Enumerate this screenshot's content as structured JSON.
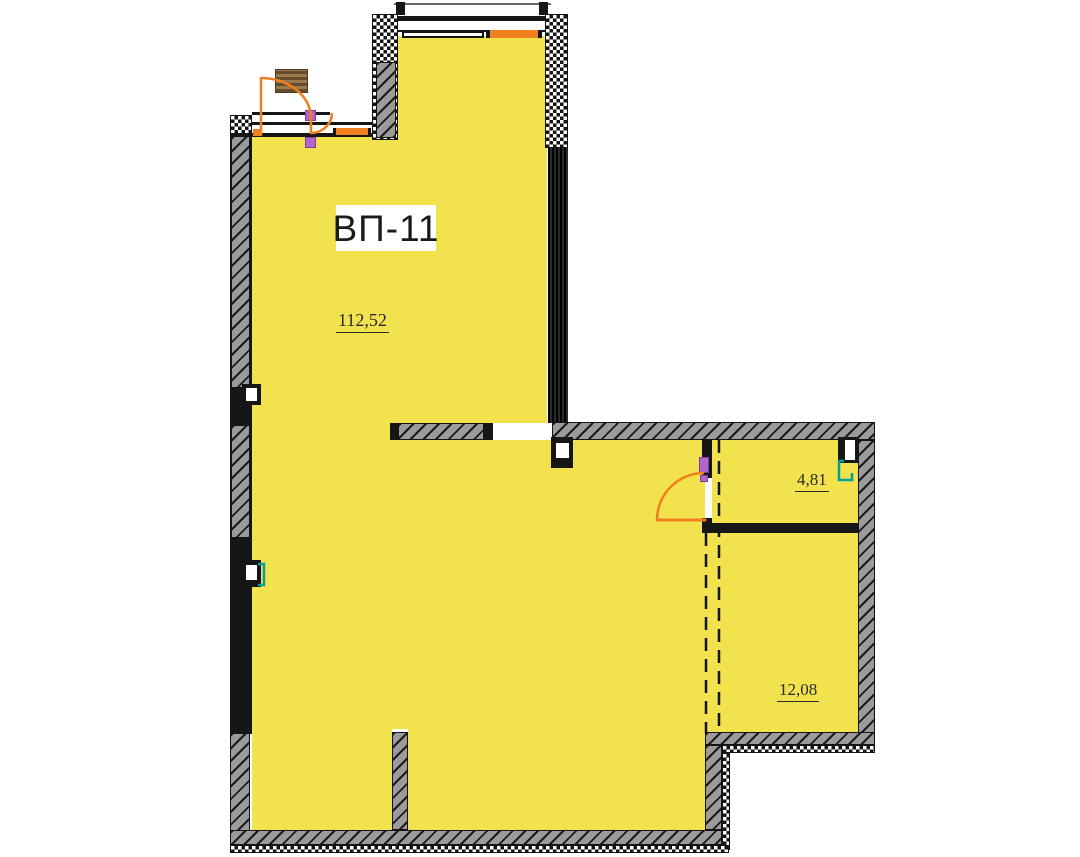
{
  "plan": {
    "unit_label": "ВП-11",
    "rooms": [
      {
        "name": "main-room",
        "area": "112,52"
      },
      {
        "name": "side-room-upper",
        "area": "4,81"
      },
      {
        "name": "side-room-lower",
        "area": "12,08"
      }
    ],
    "colors": {
      "floor": "#F2E24E",
      "door": "#F07F1F",
      "wall": "#161616",
      "concrete": "#9B9B9B",
      "fixture": "#00A295",
      "hinge": "#B266CC",
      "wood": "#9C7A4E",
      "paper": "#ffffff"
    }
  }
}
